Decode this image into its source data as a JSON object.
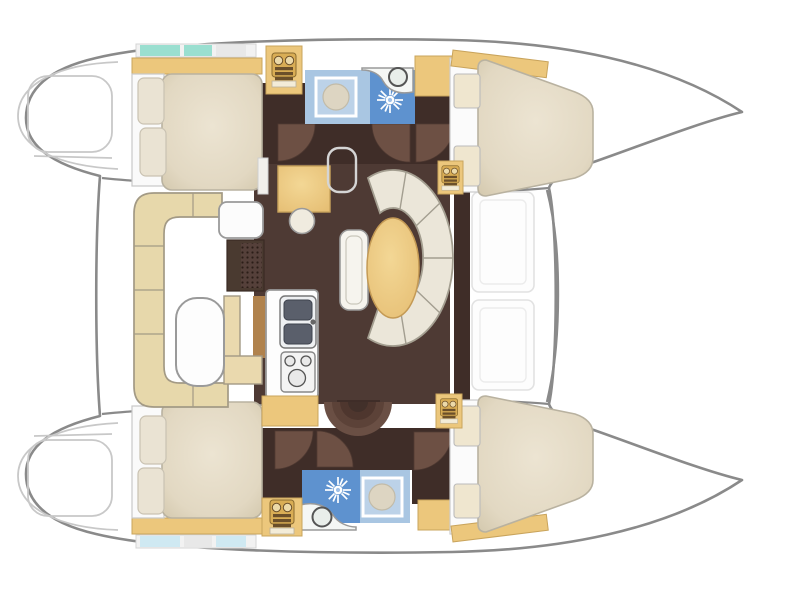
{
  "diagram": {
    "type": "catamaran-floor-plan",
    "view": "top-down",
    "orientation": {
      "bow": "right",
      "stern": "left"
    },
    "hulls": [
      {
        "id": "port-hull",
        "position": "top",
        "rooms": [
          "aft-double-cabin",
          "head-with-shower",
          "corridor",
          "forward-double-cabin"
        ]
      },
      {
        "id": "starboard-hull",
        "position": "bottom",
        "rooms": [
          "aft-double-cabin",
          "head-with-shower",
          "corridor",
          "forward-double-cabin"
        ]
      }
    ],
    "bridgedeck": {
      "rooms": [
        "salon",
        "navigation-station",
        "galley",
        "companionway-steps"
      ],
      "furniture": [
        "curved-settee",
        "oval-dining-table",
        "nav-table",
        "nav-stool",
        "double-sink",
        "two-plus-one-burner-stove",
        "bench-seat"
      ]
    },
    "exterior": [
      "cockpit-with-c-bench",
      "cockpit-table",
      "aft-swim-platforms",
      "foredeck",
      "trampoline-area-between-bows"
    ]
  },
  "fixtures": [
    "shower-starburst-icon",
    "round-sink-icon",
    "shower-tray-icon",
    "stove-burner-icon",
    "companionway-steps-icon",
    "door-swing-arc",
    "deck-grate",
    "pillow",
    "window-hatch"
  ],
  "palette": {
    "outline": "#8a8a8a",
    "outline_light": "#c8c8c8",
    "hull_fill": "#ffffff",
    "cabinet_tan": "#ecc77c",
    "cabinet_tan_deep": "#d9ad55",
    "berth_cream": "#e7dfcc",
    "berth_edge": "#b9b2a0",
    "settee_cream": "#ebe6d9",
    "settee_outline": "#a39e90",
    "salon_floor": "#4e3a34",
    "corridor_floor": "#3f2d28",
    "door_arc": "#6d5044",
    "table_tan": "#eec87f",
    "bath_blue": "#5e92cf",
    "bath_blue_light": "#a9c6e2",
    "teal_window": "#9adfd0",
    "cushion_khaki": "#e7d8ab",
    "counter_white": "#fdfdfd",
    "sink_dark": "#5a5f6b",
    "grate_brown": "#4a3a30",
    "galley_cabinet_brown": "#b0824d"
  }
}
